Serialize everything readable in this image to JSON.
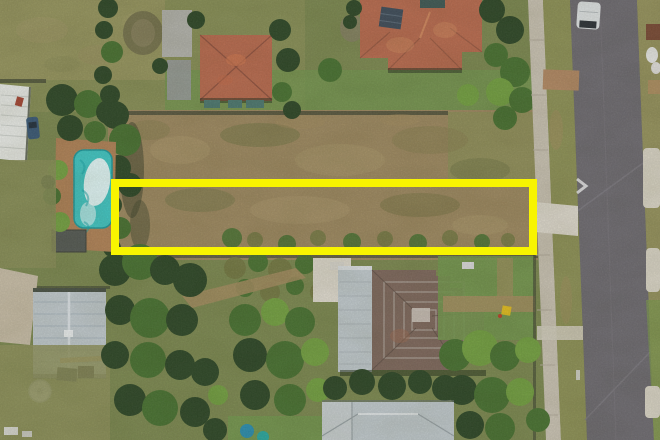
{
  "scene": {
    "type": "aerial-drone-photograph",
    "subject": "vacant residential land parcel outlined with a yellow highlight rectangle",
    "objects": [
      {
        "name": "vacant-lot",
        "desc": "long cleared strip of patchy brown/olive scrub grass"
      },
      {
        "name": "lot-boundary-highlight",
        "desc": "bright yellow rectangle annotation around the parcel"
      },
      {
        "name": "swimming-pool",
        "desc": "turquoise backyard pool with sun glare, tan paved deck, west neighbour"
      },
      {
        "name": "neighbor-house-west",
        "desc": "square terracotta pyramid-roof house, top centre-left"
      },
      {
        "name": "neighbor-house-north",
        "desc": "large terracotta hip-roof house with dark solar panel, top right"
      },
      {
        "name": "pyramid-roof-house",
        "desc": "brown stepped tile hip roof house south of the lot"
      },
      {
        "name": "bottom-house-roof",
        "desc": "pale grey metal roof at bottom edge"
      },
      {
        "name": "garden-shed-roof",
        "desc": "light blue-grey gable shed roof, bottom left"
      },
      {
        "name": "carport-roof",
        "desc": "white panel roof at far left edge"
      },
      {
        "name": "water-tank",
        "desc": "round white rainwater tank"
      },
      {
        "name": "footpath",
        "desc": "concrete sidewalk running north-south"
      },
      {
        "name": "road",
        "desc": "asphalt street along right side"
      },
      {
        "name": "white-van",
        "desc": "white van parked on road, top right"
      },
      {
        "name": "road-marking-arrow",
        "desc": "small white chevron painted near kerb"
      },
      {
        "name": "driveway-crossovers",
        "desc": "concrete and brick kerb crossovers onto the street"
      },
      {
        "name": "tree-clusters",
        "desc": "dense green tree canopies south and west of the lot"
      }
    ]
  },
  "highlight": {
    "x": 115,
    "y": 183,
    "w": 418,
    "h": 68,
    "stroke_width": 8
  },
  "palette": {
    "grass_base": "#7d8a4f",
    "grass_dry": "#98975e",
    "grass_lush": "#74984d",
    "scrub_tan": "#9f8a5f",
    "scrub_olive": "#757a42",
    "tree_dark": "#2d4725",
    "tree_mid": "#48722f",
    "tree_light": "#74a240",
    "roof_terracotta": "#bb6b4d",
    "roof_terracotta_light": "#d88f60",
    "roof_brown_tile": "#80695c",
    "roof_tile_light": "#b2a89e",
    "roof_metal": "#c3cccf",
    "concrete_path": "#ccc5b4",
    "concrete_bright": "#e2ddd0",
    "road_asphalt": "#6f6c71",
    "road_seam": "#807d83",
    "pool_water": "#3fc7c3",
    "pool_glare": "#ecfcfb",
    "paving_tan": "#b28355",
    "white_structure": "#eceee9",
    "fence_dark": "#3e4430",
    "dirt_tan": "#a78e5f",
    "van_body": "#e3e7e8",
    "solar_panel": "#3e4c59",
    "awning_teal": "#4d7a71",
    "car_blue": "#3a5a78",
    "tank_white": "#d9dcd4",
    "toy_yellow": "#e6c01c",
    "highlight_yellow": "#f8f400"
  }
}
